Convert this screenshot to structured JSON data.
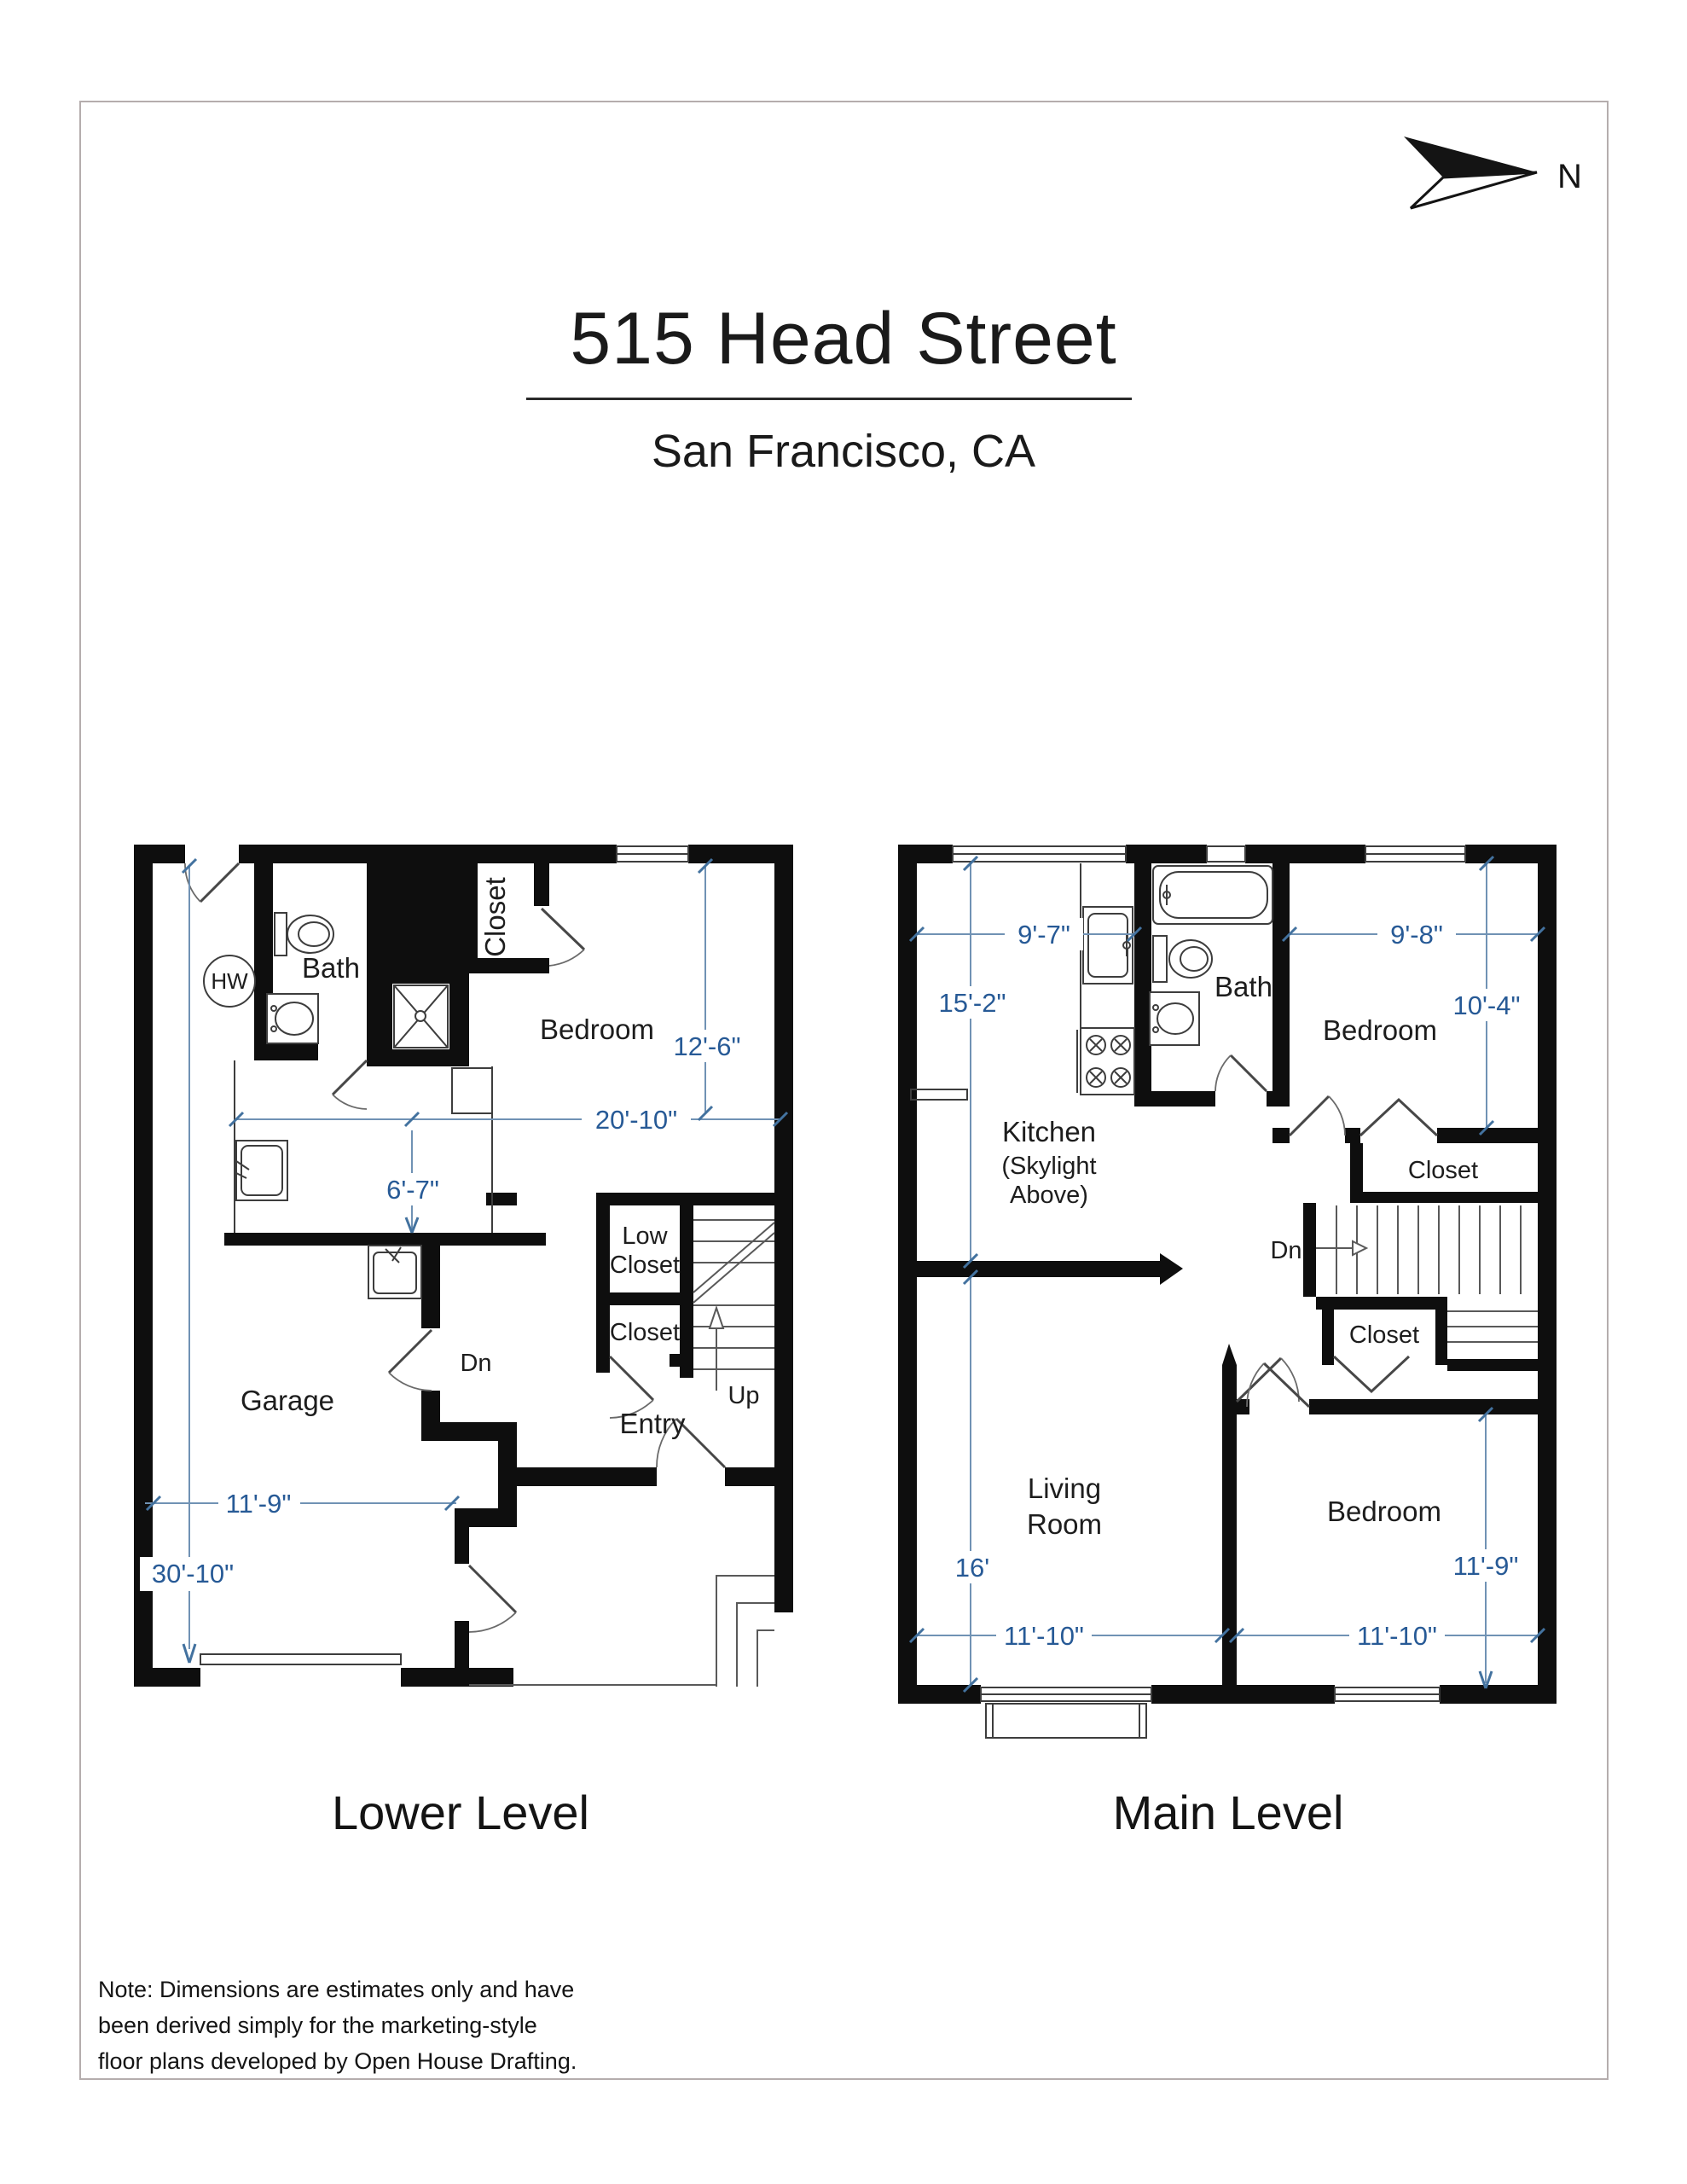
{
  "colors": {
    "dimension_blue": "#275a96",
    "dimension_line_blue": "#7092b4",
    "wall_black": "#0e0e0e",
    "frame_gray": "#b5adad"
  },
  "header": {
    "title": "515 Head Street",
    "subtitle": "San Francisco, CA",
    "north_label": "N"
  },
  "lower": {
    "level_label": "Lower Level",
    "rooms": {
      "bath": "Bath",
      "closet_top": "Closet",
      "bedroom": "Bedroom",
      "low_closet_line1": "Low",
      "low_closet_line2": "Closet",
      "closet_mid": "Closet",
      "garage": "Garage",
      "entry": "Entry"
    },
    "annotations": {
      "hw": "HW",
      "dn": "Dn",
      "up": "Up"
    },
    "dims": {
      "bedroom_depth": "12'-6\"",
      "upper_width": "20'-10\"",
      "laundry_depth": "6'-7\"",
      "garage_width": "11'-9\"",
      "overall_depth": "30'-10\""
    }
  },
  "main": {
    "level_label": "Main Level",
    "rooms": {
      "kitchen": "Kitchen",
      "kitchen_note_line1": "(Skylight",
      "kitchen_note_line2": "Above)",
      "bath": "Bath",
      "bedroom_top": "Bedroom",
      "closet_top": "Closet",
      "closet_mid": "Closet",
      "living_line1": "Living",
      "living_line2": "Room",
      "bedroom_bottom": "Bedroom"
    },
    "annotations": {
      "dn": "Dn"
    },
    "dims": {
      "kitchen_width": "9'-7\"",
      "kitchen_depth": "15'-2\"",
      "bedroom_top_width": "9'-8\"",
      "bedroom_top_depth": "10'-4\"",
      "living_depth": "16'",
      "living_width": "11'-10\"",
      "bedroom_bottom_depth": "11'-9\"",
      "bedroom_bottom_width": "11'-10\""
    }
  },
  "note": {
    "line1": "Note: Dimensions are estimates only and have",
    "line2": "been derived simply for the marketing-style",
    "line3": "floor plans developed by Open House Drafting."
  }
}
